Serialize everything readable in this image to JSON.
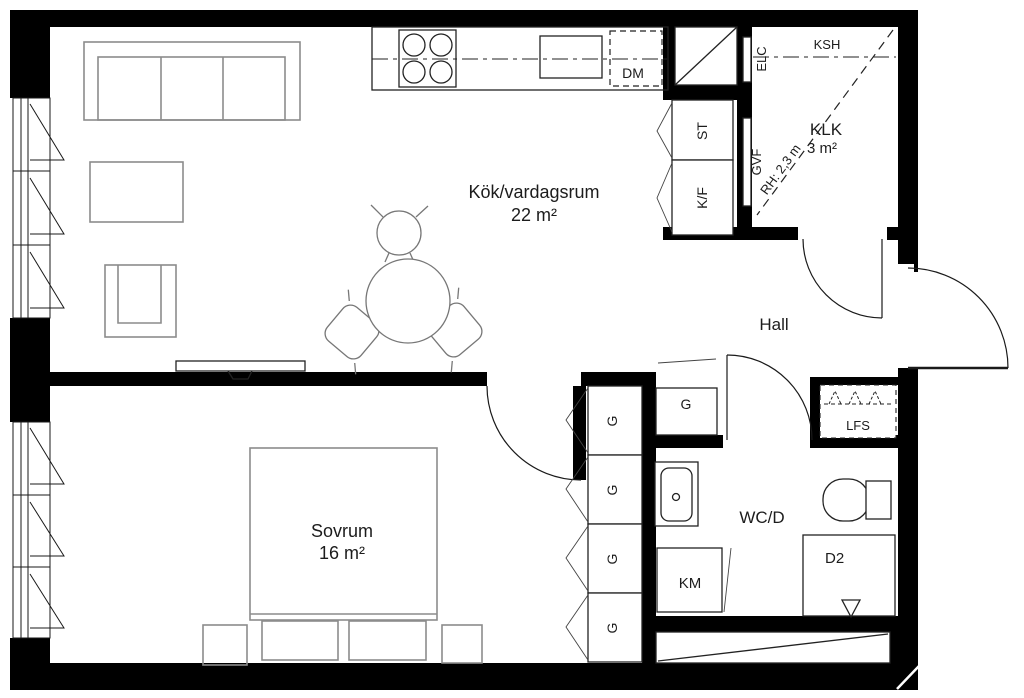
{
  "title": "Apartment floor plan",
  "rooms": {
    "kitchen_living": {
      "name": "Kök/vardagsrum",
      "area": "22 m²"
    },
    "bedroom": {
      "name": "Sovrum",
      "area": "16 m²"
    },
    "hall": {
      "name": "Hall"
    },
    "bathroom": {
      "name": "WC/D"
    },
    "walk_in_closet": {
      "name": "KLK",
      "area": "3 m²",
      "ceiling_height": "RH: 2,3 m"
    }
  },
  "fixtures": {
    "dishwasher": "DM",
    "cleaning_cabinet": "ST",
    "fridge_freezer": "K/F",
    "electrical_cabinet": "ELC",
    "ksh_shelf": "KSH",
    "gvf_panel": "GVF",
    "wardrobe": "G",
    "washing_machine": "KM",
    "shower": "D2",
    "hat_shelf": "LFS"
  },
  "colors": {
    "wall": "#000000",
    "text": "#1c1c1c",
    "furniture": "#8c8c8c",
    "background": "#ffffff"
  }
}
